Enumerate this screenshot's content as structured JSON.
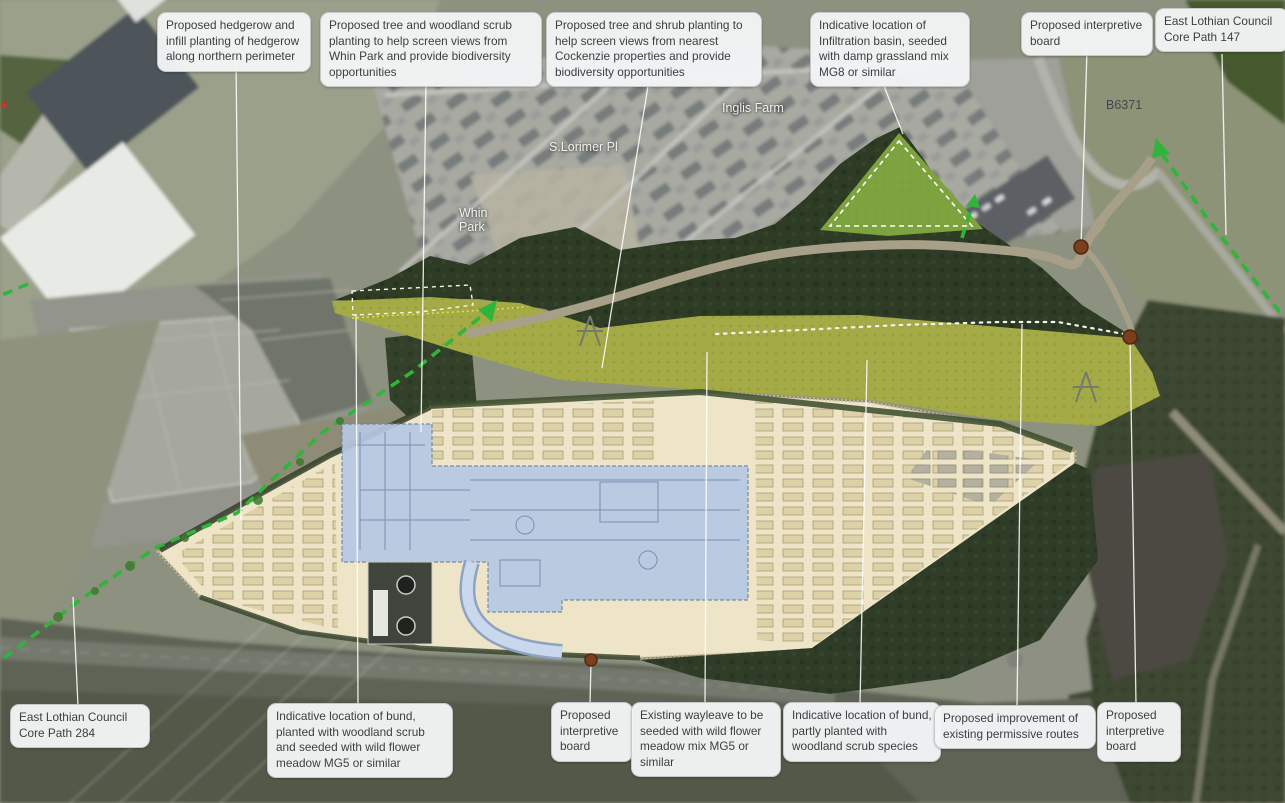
{
  "map_title": "Landscape proposals annotated aerial plan",
  "top_callouts": [
    {
      "id": "hedgerow",
      "text": "Proposed hedgerow and infill planting of hedgerow along northern perimeter"
    },
    {
      "id": "woodland-scrub-whin-park",
      "text": "Proposed tree and woodland scrub planting to help screen views from Whin Park and provide biodiversity opportunities"
    },
    {
      "id": "tree-shrub-cockenzie",
      "text": "Proposed tree and shrub planting to help screen views from nearest Cockenzie properties and provide biodiversity opportunities"
    },
    {
      "id": "infiltration-basin",
      "text": "Indicative location of Infiltration basin, seeded with damp grassland mix MG8 or similar"
    },
    {
      "id": "interpretive-board-north",
      "text": "Proposed interpretive board"
    },
    {
      "id": "core-path-147",
      "text": "East Lothian Council Core Path 147"
    }
  ],
  "bottom_callouts": [
    {
      "id": "core-path-284",
      "text": "East Lothian Council Core Path 284"
    },
    {
      "id": "bund-woodland-mg5",
      "text": "Indicative location of bund, planted with woodland scrub and seeded with wild flower meadow MG5 or similar"
    },
    {
      "id": "interpretive-board-southwest",
      "text": "Proposed interpretive board"
    },
    {
      "id": "wayleave-mg5",
      "text": "Existing wayleave to be seeded with wild flower meadow mix MG5 or similar"
    },
    {
      "id": "bund-partly-planted",
      "text": "Indicative location of bund, partly planted with woodland scrub species"
    },
    {
      "id": "permissive-routes",
      "text": "Proposed improvement of existing permissive routes"
    },
    {
      "id": "interpretive-board-southeast",
      "text": "Proposed interpretive board"
    }
  ],
  "place_labels": [
    {
      "id": "inglis-farm",
      "text": "Inglis Farm"
    },
    {
      "id": "s-lorimer-pl",
      "text": "S.Lorimer Pl"
    },
    {
      "id": "whin-park",
      "text": "Whin\nPark"
    },
    {
      "id": "b6371",
      "text": "B6371"
    }
  ],
  "colors": {
    "callout_background": "#f3f4f5",
    "callout_text": "#3b3e41",
    "leader_line": "#ffffff",
    "core_path_green": "#2fb43c",
    "site_platform_cream": "#eee5c8",
    "substation_overlay_blue": "#b7c8e2",
    "grassland_olive": "#a4aa45",
    "woodland_dark_green": "#2e3b25",
    "infiltration_basin_green": "#7da33f",
    "interpretive_board_marker": "#7b3f1d"
  }
}
